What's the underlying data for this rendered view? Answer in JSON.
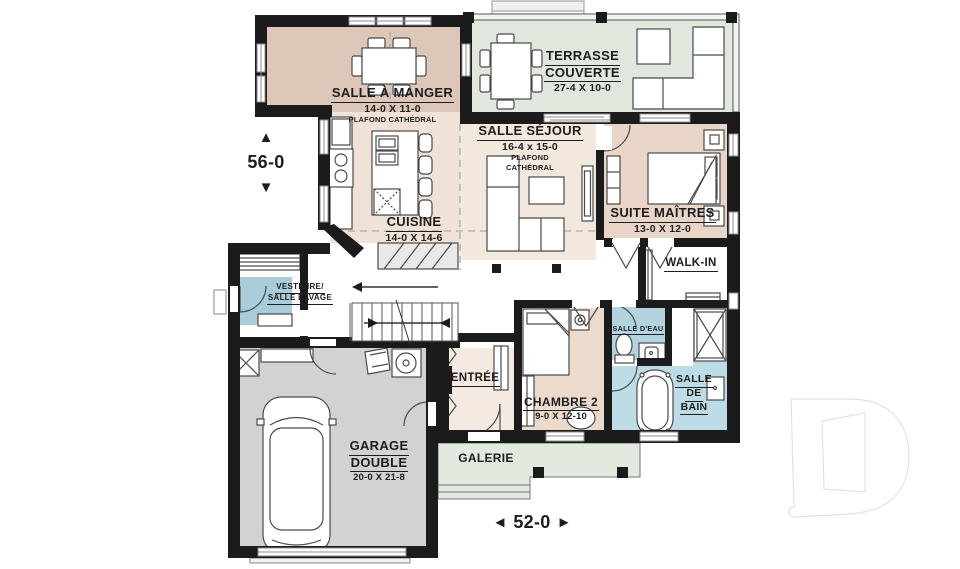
{
  "plan": {
    "overall_depth": "56-0",
    "overall_width": "52-0"
  },
  "icons": {
    "arrow_up": "▲",
    "arrow_down": "▼",
    "arrow_left": "◄",
    "arrow_right": "►"
  },
  "rooms": {
    "dining": {
      "name": "SALLE À MANGER",
      "dims": "14-0 X 11-0",
      "note": "PLAFOND CATHÉDRAL"
    },
    "terrace": {
      "line1": "TERRASSE",
      "line2": "COUVERTE",
      "dims": "27-4 X 10-0"
    },
    "living": {
      "name": "SALLE SÉJOUR",
      "dims": "16-4 x 15-0",
      "note1": "PLAFOND",
      "note2": "CATHÉDRAL"
    },
    "kitchen": {
      "name": "CUISINE",
      "dims": "14-0 X 14-6"
    },
    "master": {
      "name": "SUITE MAÎTRES",
      "dims": "13-0 X 12-0"
    },
    "walkin": {
      "name": "WALK-IN"
    },
    "mudroom": {
      "line1": "VESTIAIRE/",
      "line2": "SALLE LAVAGE"
    },
    "entry": {
      "name": "ENTRÉE"
    },
    "bedroom2": {
      "name": "CHAMBRE 2",
      "dims": "9-0 X 12-10"
    },
    "powder": {
      "name": "SALLE D'EAU"
    },
    "bath": {
      "line1": "SALLE",
      "line2": "DE",
      "line3": "BAIN"
    },
    "garage": {
      "line1": "GARAGE",
      "line2": "DOUBLE",
      "dims": "20-0 X 21-8"
    },
    "porch": {
      "name": "GALERIE"
    }
  },
  "colors": {
    "wall": "#1b1b1b",
    "dining_fill": "#dcc7b8",
    "kitchen_fill": "#f0e2d6",
    "living_fill": "#f3e8de",
    "master_fill": "#e9d6c9",
    "bedroom2_fill": "#ecdacd",
    "entry_fill": "#f4eae2",
    "terrace_fill": "#e0e7dd",
    "porch_fill": "#e2e9df",
    "porch_step_fill": "#ebf1e9",
    "mudroom_fill": "#a8ccd9",
    "powder_fill": "#b3d4df",
    "bath_fill": "#bedce5",
    "garage_fill": "#d2d2d2"
  }
}
